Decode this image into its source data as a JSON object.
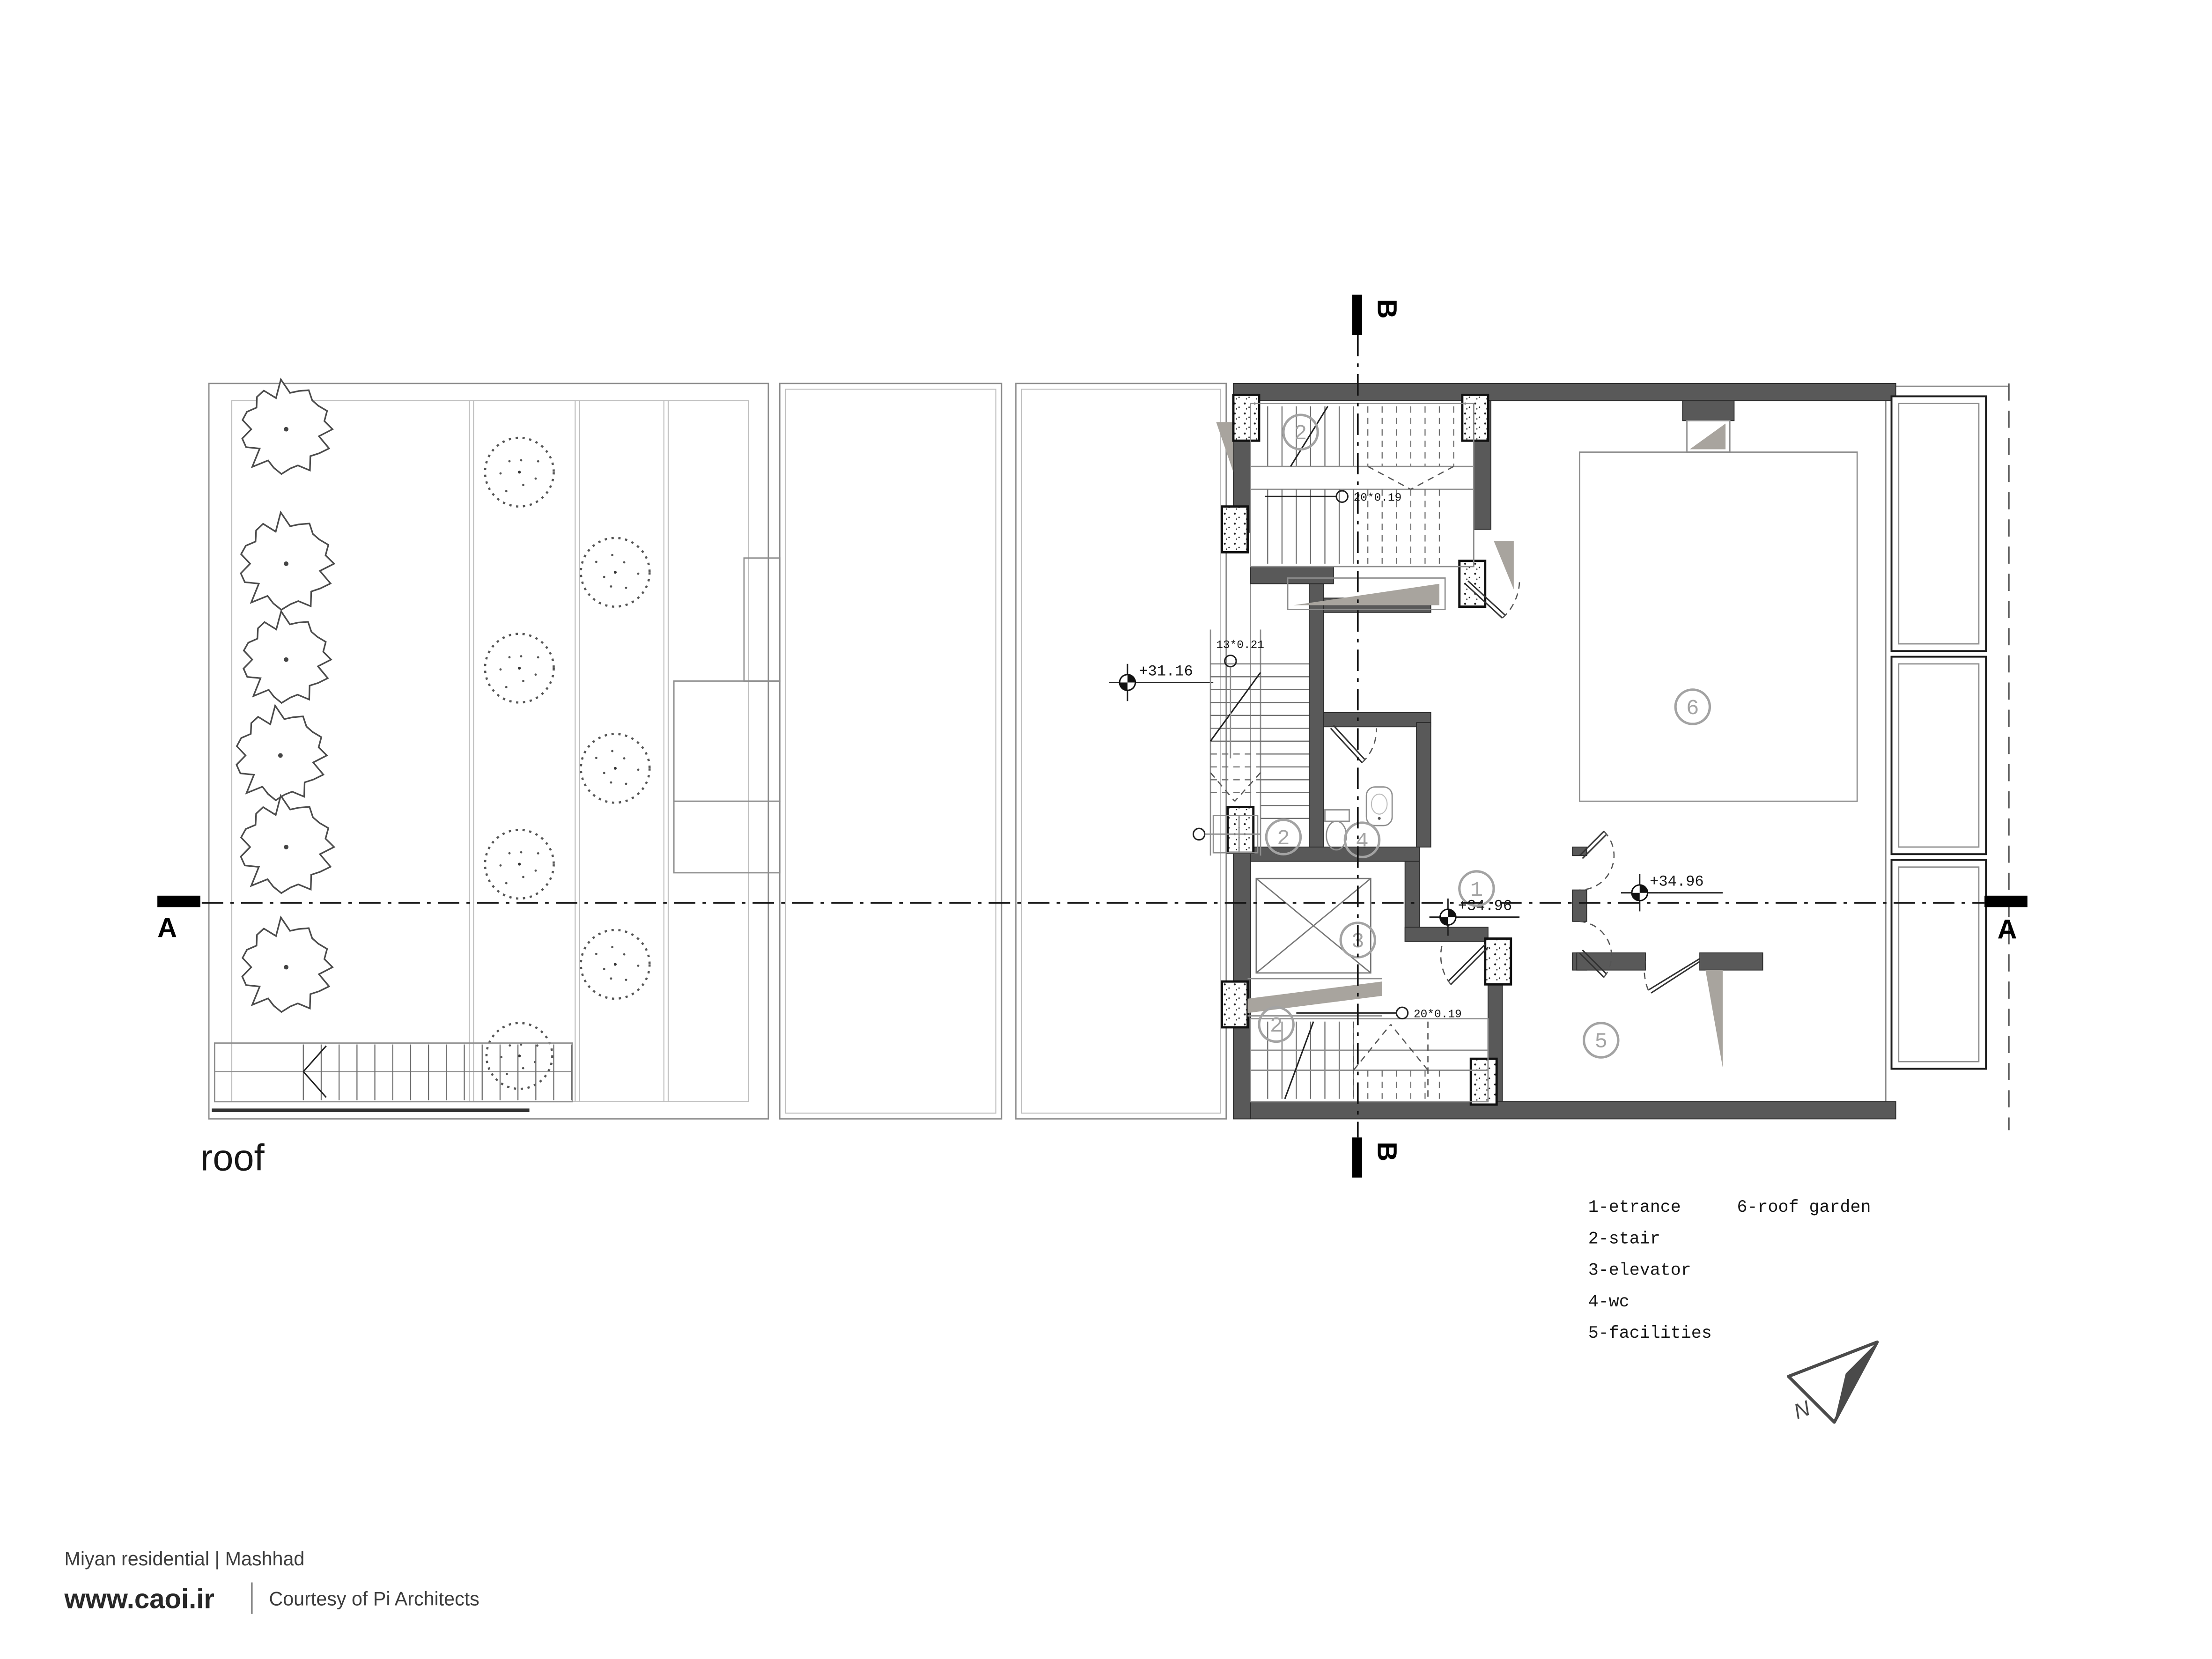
{
  "title": {
    "label": "roof"
  },
  "plan": {
    "section_markers": {
      "a_label": "A",
      "b_label": "B"
    },
    "levels": [
      {
        "name": "flat-roof-level",
        "value": "+31.16"
      },
      {
        "name": "entrance-level",
        "value": "+34.96"
      },
      {
        "name": "roof-garden-level",
        "value": "+34.96"
      }
    ],
    "stair_notes": [
      {
        "name": "top-stair-steps",
        "value": "20*0.19"
      },
      {
        "name": "mid-stair-steps",
        "value": "13*0.21"
      },
      {
        "name": "bottom-stair-steps",
        "value": "20*0.19"
      }
    ],
    "room_markers": [
      {
        "name": "top-stair",
        "number": "2"
      },
      {
        "name": "mid-stair",
        "number": "2"
      },
      {
        "name": "wc",
        "number": "4"
      },
      {
        "name": "entrance",
        "number": "1"
      },
      {
        "name": "elevator",
        "number": "3"
      },
      {
        "name": "facilities",
        "number": "5"
      },
      {
        "name": "roof-garden",
        "number": "6"
      },
      {
        "name": "bottom-stair",
        "number": "2"
      }
    ],
    "north": {
      "label": "N"
    }
  },
  "legend": {
    "column1": [
      "1-etrance",
      "2-stair",
      "3-elevator",
      "4-wc",
      "5-facilities"
    ],
    "column2": [
      "6-roof garden"
    ]
  },
  "footer": {
    "project": "Miyan residential | Mashhad",
    "site": "www.caoi.ir",
    "credit": "Courtesy of Pi Architects"
  },
  "colors": {
    "wall_fill": "#595959",
    "shade_gray": "#a8a49e",
    "marker_gray": "#a3a3a3",
    "ink": "#1c1c1c",
    "background": "#ffffff"
  }
}
